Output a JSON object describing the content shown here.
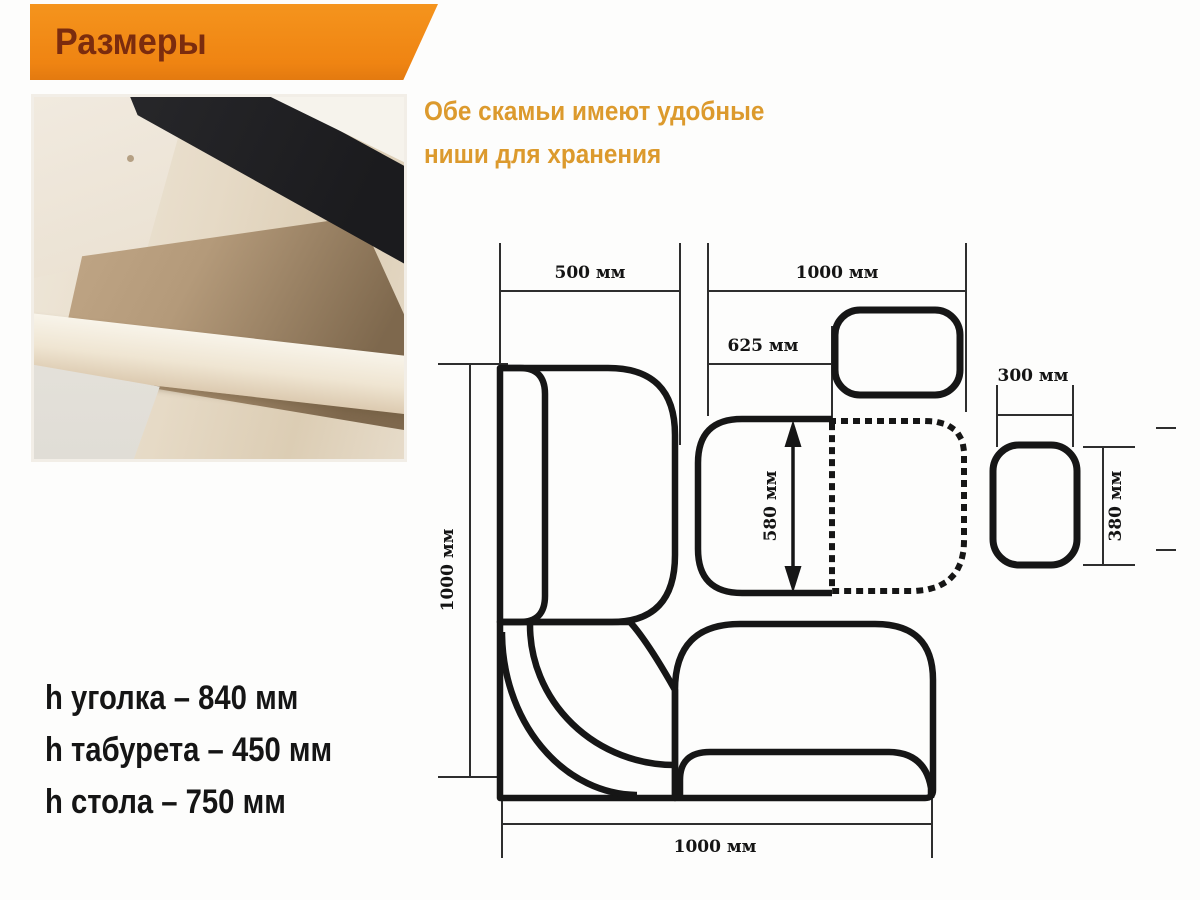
{
  "header": {
    "title": "Размеры"
  },
  "intro": {
    "line1": "Обе скамьи имеют удобные",
    "line2": "ниши для хранения"
  },
  "specs": {
    "corner_height": "h уголка – 840 мм",
    "stool_height": "h табурета – 450 мм",
    "table_height": "h стола – 750 мм"
  },
  "diagram": {
    "dim_bench_left_width": "500 мм",
    "dim_top_span": "1000 мм",
    "dim_table_offset": "625 мм",
    "dim_seat_depth": "580 мм",
    "dim_left_length": "1000 мм",
    "dim_bottom_length": "1000 мм",
    "dim_stool_width": "300 мм",
    "dim_stool_depth": "380 мм"
  },
  "colors": {
    "banner_orange": "#EF8412",
    "banner_title": "#7B2C0E",
    "note_orange": "#DC9A2D",
    "diagram_ink": "#161616",
    "spec_text": "#151515"
  }
}
